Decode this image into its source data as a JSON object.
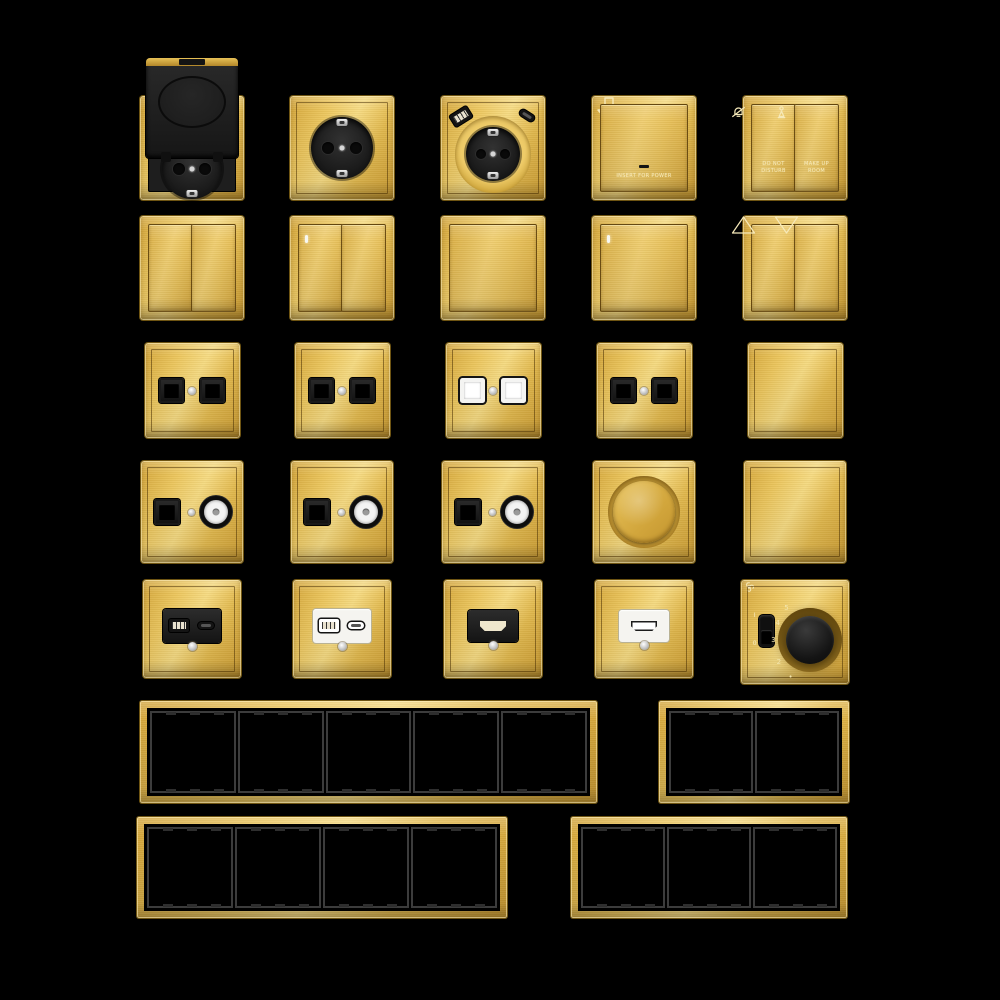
{
  "scene": {
    "description": "Collection of gold brushed-metal wall switches, sockets and frames on black background",
    "colors": {
      "background": "#000000",
      "gold": "#e2b94e",
      "gold_light": "#f6db83",
      "gold_dark": "#cf9f34",
      "module_black": "#1e1e1e",
      "module_white": "#f5f4f0",
      "engraving": "#f6e9b9"
    }
  },
  "items": [
    {
      "row": 1,
      "col": 1,
      "type": "socket-flip",
      "name": "schuko-socket-flip-cover"
    },
    {
      "row": 1,
      "col": 2,
      "type": "schuko",
      "name": "schuko-socket"
    },
    {
      "row": 1,
      "col": 3,
      "type": "schuko-usb",
      "name": "schuko-socket-with-usb"
    },
    {
      "row": 1,
      "col": 4,
      "type": "keycard",
      "name": "keycard-power-switch",
      "label": "INSERT FOR POWER"
    },
    {
      "row": 1,
      "col": 5,
      "type": "service",
      "name": "hotel-service-switch",
      "buttons": [
        {
          "icon": "bell-slash-icon",
          "label": "DO NOT DISTURB"
        },
        {
          "icon": "housekeeping-icon",
          "label": "MAKE UP ROOM"
        }
      ]
    },
    {
      "row": 2,
      "col": 1,
      "type": "rocker2",
      "name": "two-gang-switch",
      "led": false
    },
    {
      "row": 2,
      "col": 2,
      "type": "rocker2",
      "name": "two-gang-switch-indicator",
      "led": true
    },
    {
      "row": 2,
      "col": 3,
      "type": "rocker1",
      "name": "one-gang-switch",
      "led": false
    },
    {
      "row": 2,
      "col": 4,
      "type": "rocker1",
      "name": "one-gang-switch-indicator",
      "led": true
    },
    {
      "row": 2,
      "col": 5,
      "type": "curtain",
      "name": "curtain-blind-switch"
    },
    {
      "row": 3,
      "col": 1,
      "type": "dualjack",
      "name": "double-data-socket-black",
      "variant": "black"
    },
    {
      "row": 3,
      "col": 2,
      "type": "dualjack",
      "name": "double-data-socket-black",
      "variant": "black"
    },
    {
      "row": 3,
      "col": 3,
      "type": "dualjack",
      "name": "double-data-socket-white",
      "variant": "white"
    },
    {
      "row": 3,
      "col": 4,
      "type": "dualjack",
      "name": "double-data-socket-black",
      "variant": "black"
    },
    {
      "row": 3,
      "col": 5,
      "type": "blank",
      "name": "blank-plate"
    },
    {
      "row": 4,
      "col": 1,
      "type": "jackcoax",
      "name": "data-and-tv-socket"
    },
    {
      "row": 4,
      "col": 2,
      "type": "jackcoax",
      "name": "data-and-tv-socket"
    },
    {
      "row": 4,
      "col": 3,
      "type": "jackcoax",
      "name": "data-and-tv-socket"
    },
    {
      "row": 4,
      "col": 4,
      "type": "dimmer",
      "name": "rotary-dimmer"
    },
    {
      "row": 4,
      "col": 5,
      "type": "blank",
      "name": "blank-plate"
    },
    {
      "row": 5,
      "col": 1,
      "type": "usb",
      "name": "usb-charger-socket-black",
      "variant": "black"
    },
    {
      "row": 5,
      "col": 2,
      "type": "usb",
      "name": "usb-charger-socket-white",
      "variant": "white"
    },
    {
      "row": 5,
      "col": 3,
      "type": "hdmi",
      "name": "hdmi-socket-black",
      "variant": "black"
    },
    {
      "row": 5,
      "col": 4,
      "type": "hdmi",
      "name": "hdmi-socket-white",
      "variant": "white"
    },
    {
      "row": 5,
      "col": 5,
      "type": "fan",
      "name": "fan-speed-controller",
      "scale": [
        "5",
        "4",
        "3",
        "2",
        "•"
      ],
      "toggle_labels": [
        "I",
        "0"
      ]
    }
  ],
  "frames": [
    {
      "gangs": 5,
      "name": "five-gang-frame"
    },
    {
      "gangs": 2,
      "name": "two-gang-frame"
    },
    {
      "gangs": 4,
      "name": "four-gang-frame"
    },
    {
      "gangs": 3,
      "name": "three-gang-frame"
    }
  ]
}
